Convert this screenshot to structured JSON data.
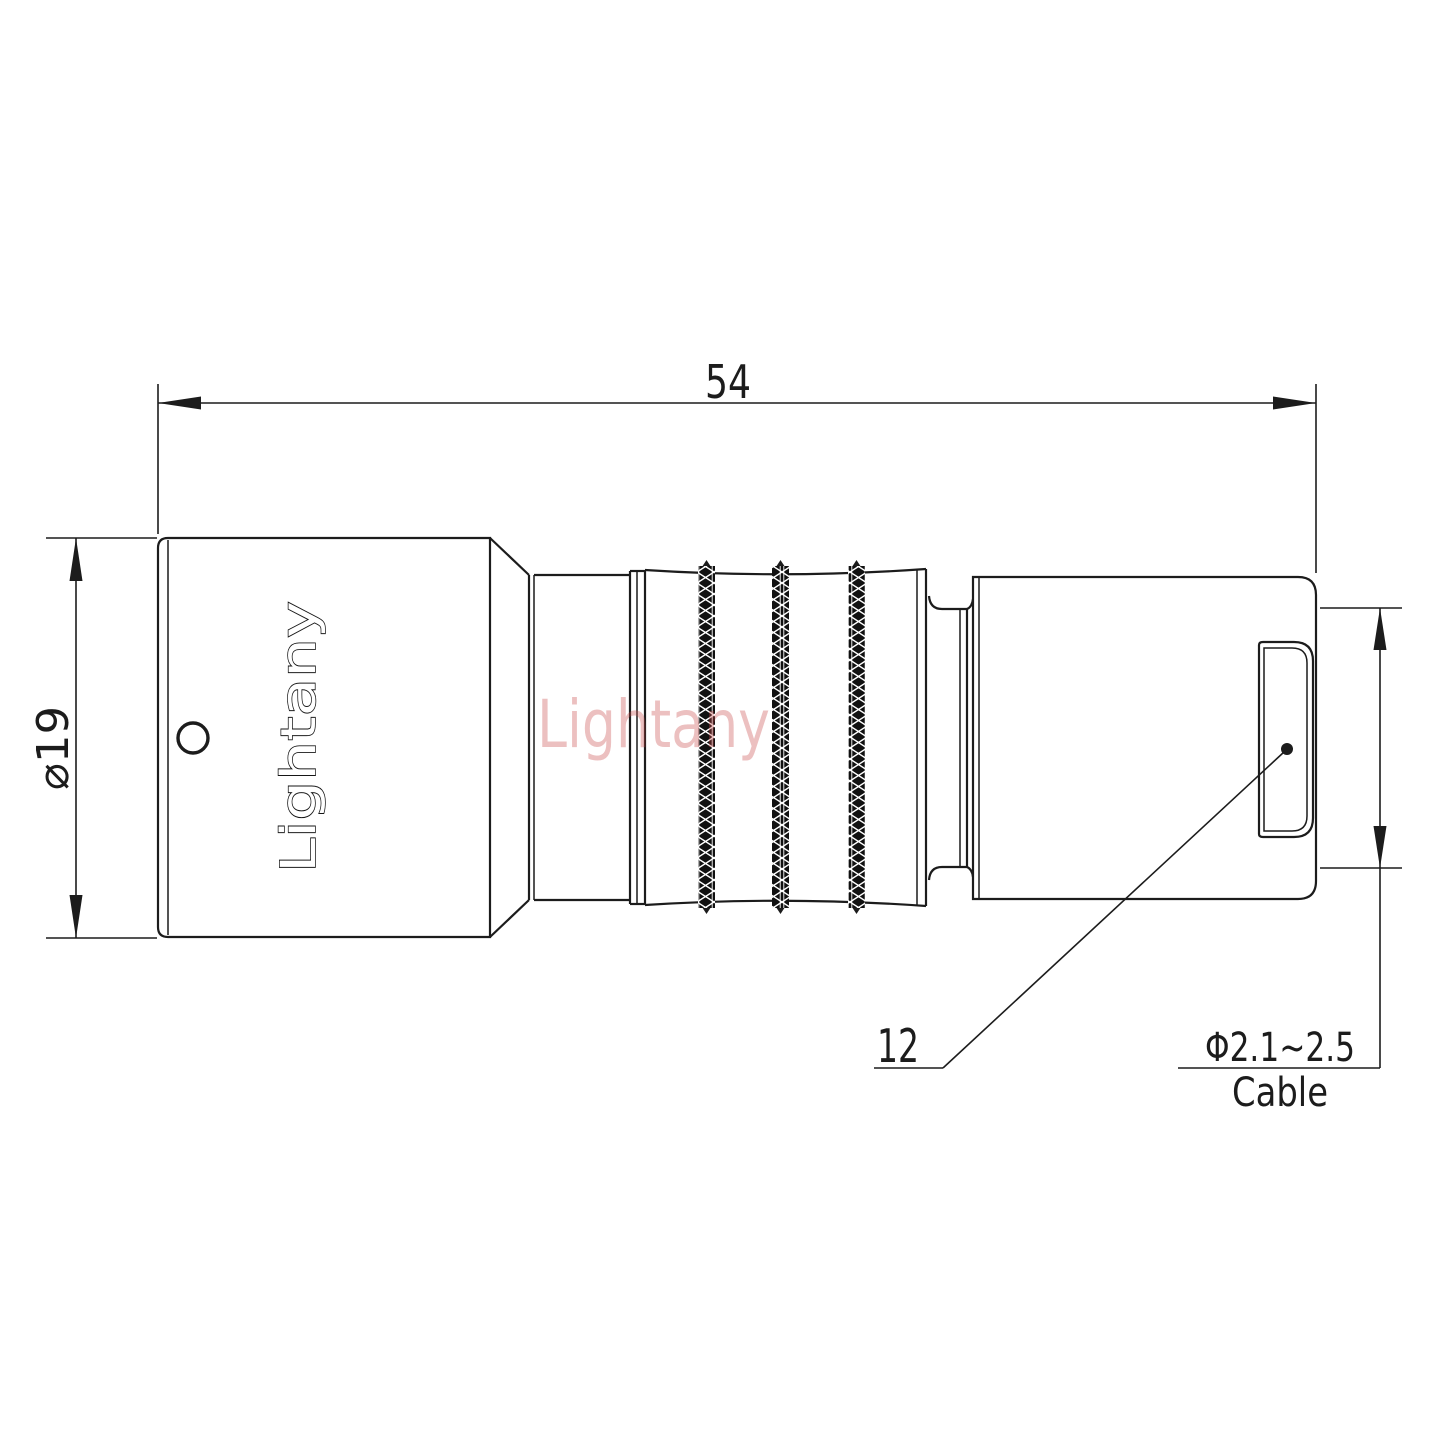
{
  "page": {
    "background": "#ffffff",
    "line_color": "#1c1c1c"
  },
  "drawing": {
    "brand_engraving": "Lightany",
    "watermark_text": "Lightany",
    "watermark_color": "#c84646"
  },
  "dimensions": {
    "overall_length": "54",
    "body_diameter": "⌀19",
    "rear_label": "12",
    "cable_diameter": "Φ2.1~2.5",
    "cable_label": "Cable"
  }
}
